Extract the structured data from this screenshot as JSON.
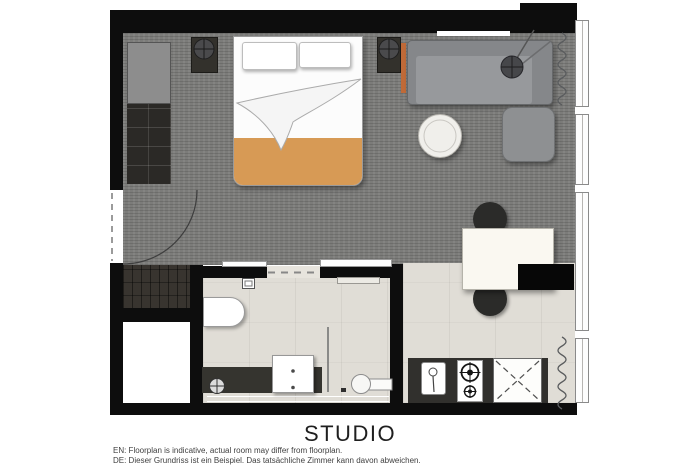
{
  "title": "STUDIO",
  "footer": {
    "en": "EN: Floorplan is indicative, actual room may differ from floorplan.",
    "de": "DE: Dieser Grundriss ist ein Beispiel. Das tatsächliche Zimmer kann davon abweichen."
  },
  "colors": {
    "wall": "#0d0d0d",
    "carpet": "#7c7c7a",
    "tile": "#e0ddd6",
    "wood_floor": "#38342f",
    "blanket_orange": "#d79a55",
    "accent_orange": "#c06a38",
    "sofa_gray": "#8b8d90",
    "counter_dark": "#31302d"
  },
  "furniture": [
    "bed",
    "pillows",
    "wardrobe",
    "nightstands",
    "bedside-lamps",
    "sofa",
    "floor-lamp",
    "ottoman",
    "round-side-table",
    "desk",
    "chairs",
    "tv-side-unit",
    "kitchen-counter",
    "kitchen-sink",
    "stove-2-burner",
    "under-counter-appliance",
    "bathtub-basin",
    "vanity-sink",
    "toilet",
    "floor-drain",
    "glass-partition",
    "entry-door",
    "sliding-door",
    "windows",
    "curtains"
  ]
}
